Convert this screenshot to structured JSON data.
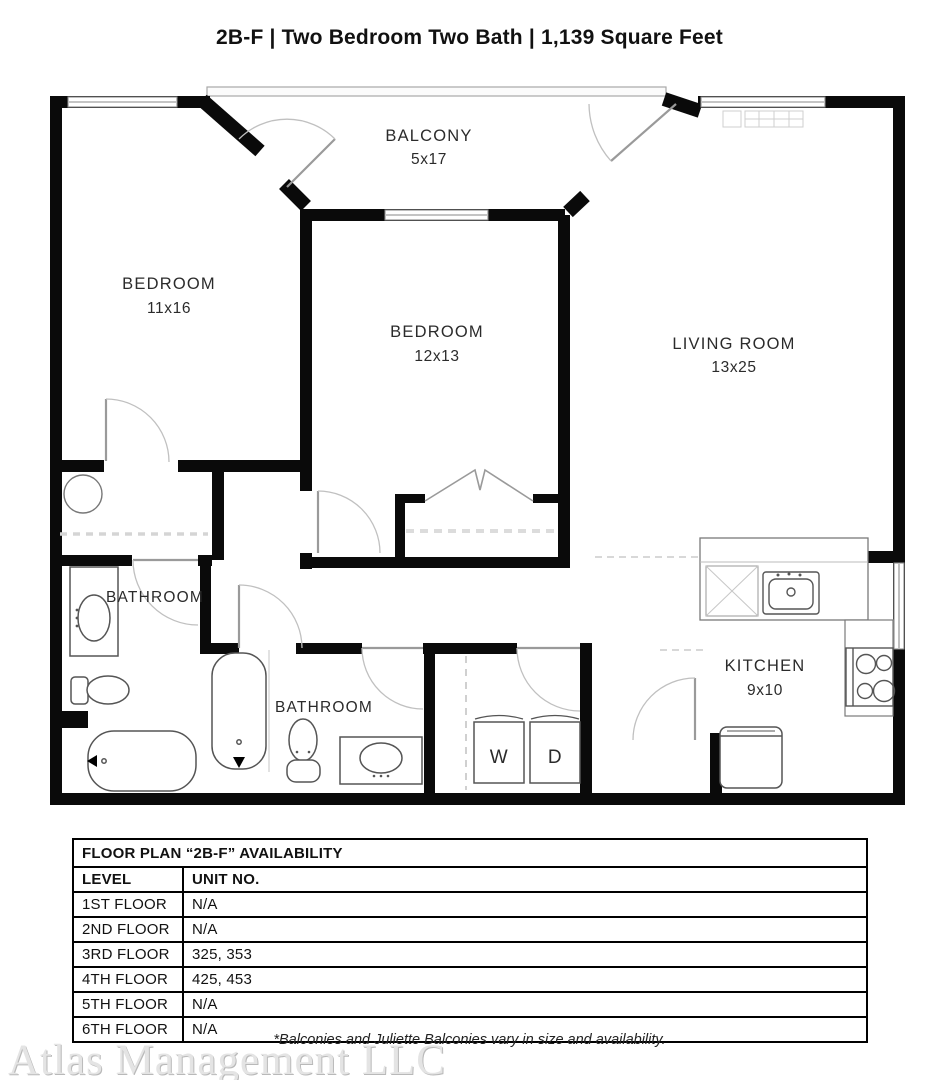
{
  "page": {
    "title": "2B-F | Two Bedroom Two Bath | 1,139 Square Feet"
  },
  "floor_plan": {
    "balcony": {
      "name": "BALCONY",
      "dims": "5x17"
    },
    "bedroom1": {
      "name": "BEDROOM",
      "dims": "11x16"
    },
    "bedroom2": {
      "name": "BEDROOM",
      "dims": "12x13"
    },
    "living_room": {
      "name": "LIVING ROOM",
      "dims": "13x25"
    },
    "bathroom1": {
      "name": "BATHROOM"
    },
    "bathroom2": {
      "name": "BATHROOM"
    },
    "kitchen": {
      "name": "KITCHEN",
      "dims": "9x10"
    },
    "washer_label": "W",
    "dryer_label": "D"
  },
  "availability": {
    "title": "FLOOR PLAN “2B-F” AVAILABILITY",
    "columns": [
      "LEVEL",
      "UNIT NO."
    ],
    "rows": [
      {
        "level": "1ST FLOOR",
        "units": "N/A"
      },
      {
        "level": "2ND FLOOR",
        "units": "N/A"
      },
      {
        "level": "3RD FLOOR",
        "units": "325, 353"
      },
      {
        "level": "4TH FLOOR",
        "units": "425, 453"
      },
      {
        "level": "5TH FLOOR",
        "units": "N/A"
      },
      {
        "level": "6TH FLOOR",
        "units": "N/A"
      }
    ]
  },
  "footer": {
    "watermark": "Atlas Management LLC",
    "disclaimer": "*Balconies and Juliette Balconies vary in size and availability."
  }
}
